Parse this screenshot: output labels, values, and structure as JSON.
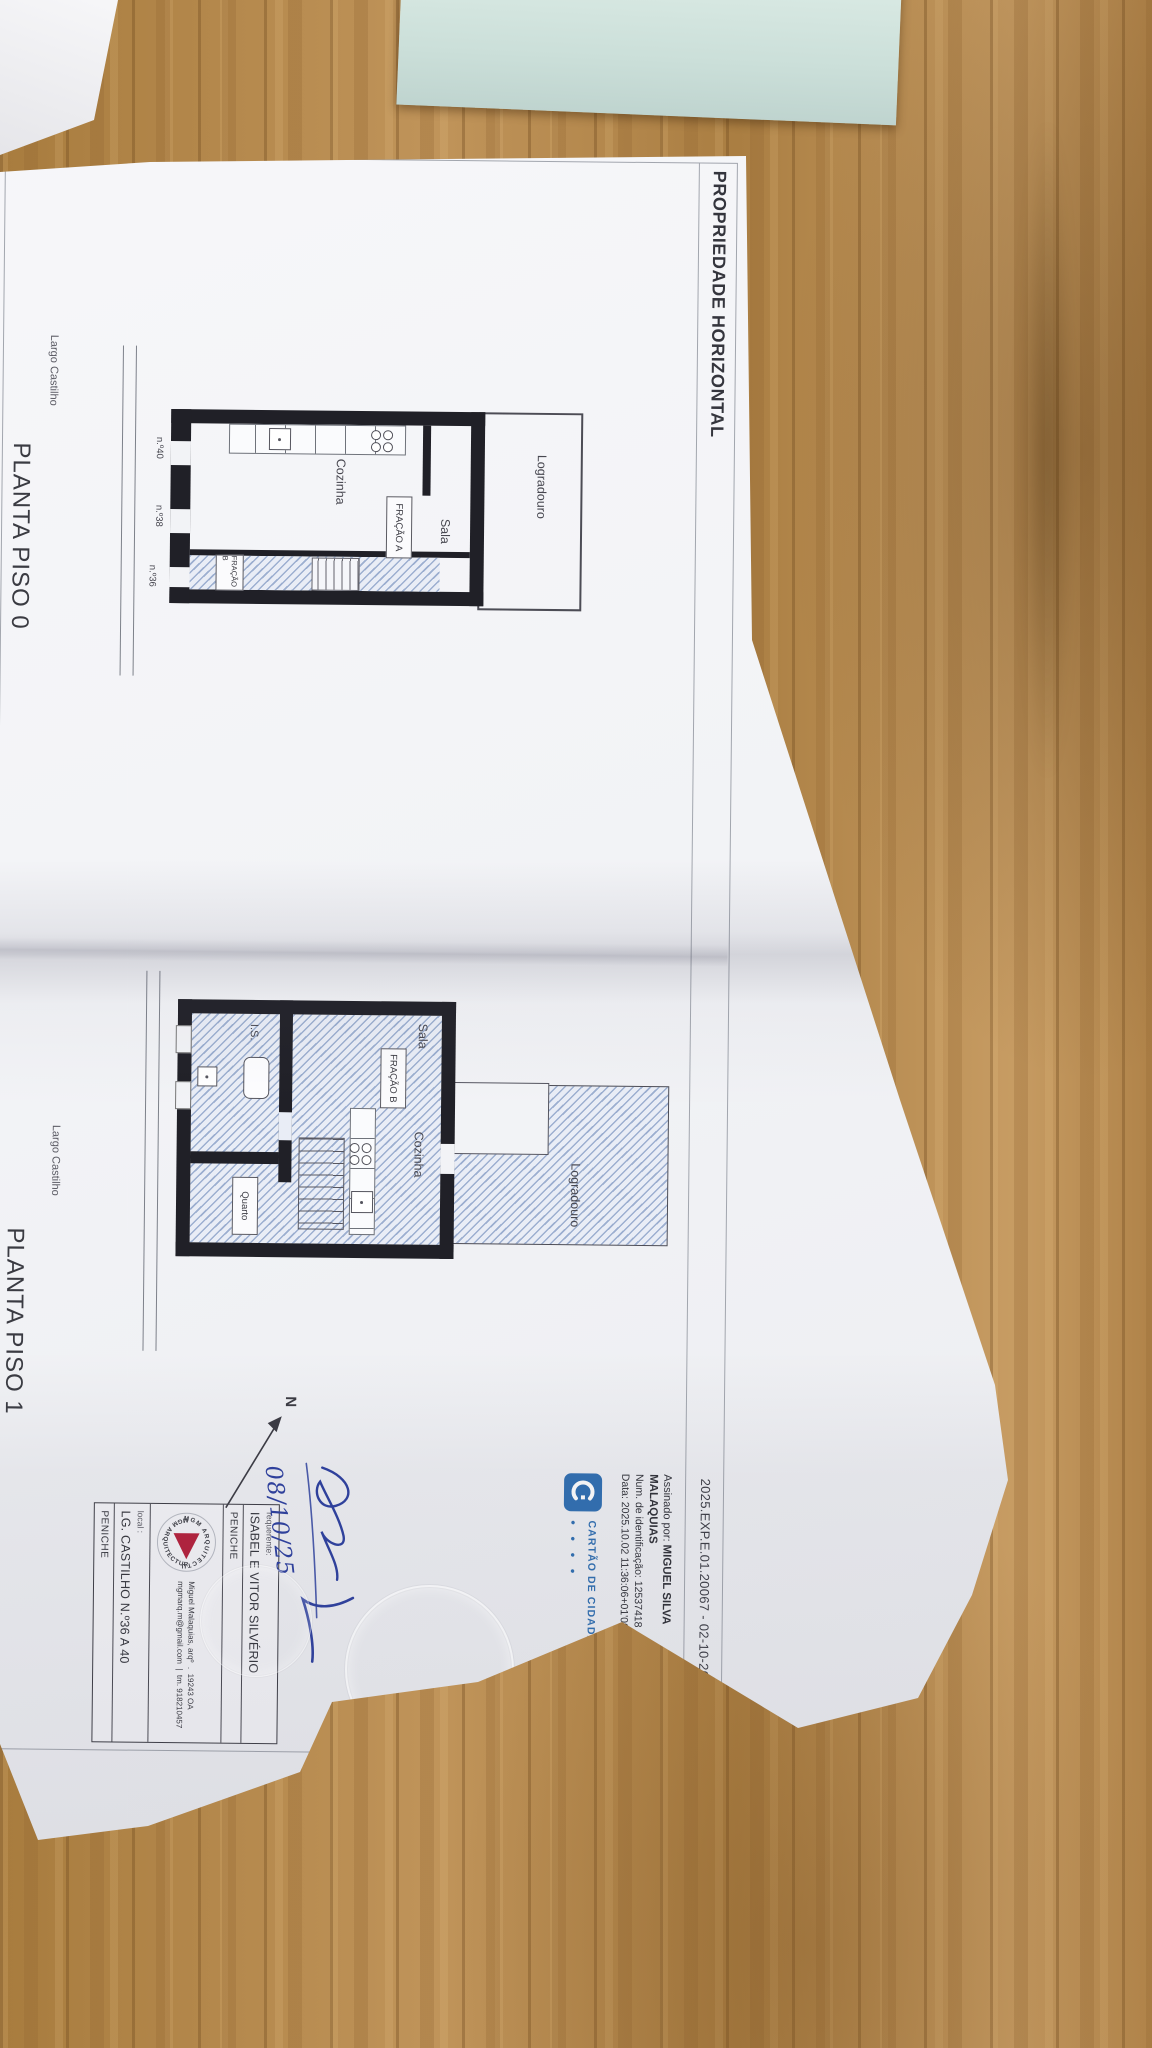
{
  "header": {
    "title": "PROPRIEDADE HORIZONTAL",
    "reference": "2025.EXP.E.01.20067 - 02-10-2025"
  },
  "plans": {
    "piso0": {
      "title": "PLANTA PISO 0",
      "street_label": "Largo Castilho",
      "rooms": {
        "logradouro": "Logradouro",
        "sala": "Sala",
        "cozinha": "Cozinha"
      },
      "fracao_a": "FRAÇÃO A",
      "fracao_b": "FRAÇÃO B",
      "doors": {
        "n40": "n.º40",
        "n38": "n.º38",
        "n36": "n.º36"
      }
    },
    "piso1": {
      "title": "PLANTA PISO 1",
      "street_label": "Largo Castilho",
      "rooms": {
        "logradouro": "Logradouro",
        "sala": "Sala",
        "cozinha": "Cozinha",
        "quarto": "Quarto",
        "is": "I.S."
      },
      "fracao_b": "FRAÇÃO B"
    }
  },
  "digital_signature": {
    "signed_label": "Assinado por:",
    "name_line1": "MIGUEL SILVA",
    "name_line2": "MALAQUIAS",
    "id_line": "Num. de identificação: 12537418",
    "date_line": "Data: 2025.10.02 11:36:06+01'00'",
    "card_logo": "CARTÃO DE CIDADÃO",
    "card_dots": "• • • •"
  },
  "title_block": {
    "requerente_label": "requerente:",
    "requerente": "ISABEL E VITOR SILVÉRIO",
    "municipality_top": "PENICHE",
    "architect": "Miguel Malaquias, arqº",
    "architect_reg": "19243 OA",
    "email": "mgmarq.m@gmail.com",
    "phone": "tm. 918210457",
    "local_label": "local :",
    "local_value": "LG. CASTILHO N.º36 A 40",
    "municipality_bottom": "PENICHE",
    "logo_text_top": "MGM ARQUITECTURA",
    "logo_text_bottom": "MGM ARQUITECTURA"
  },
  "annotations": {
    "handwritten_date": "08/10/25",
    "north_label": "N"
  }
}
